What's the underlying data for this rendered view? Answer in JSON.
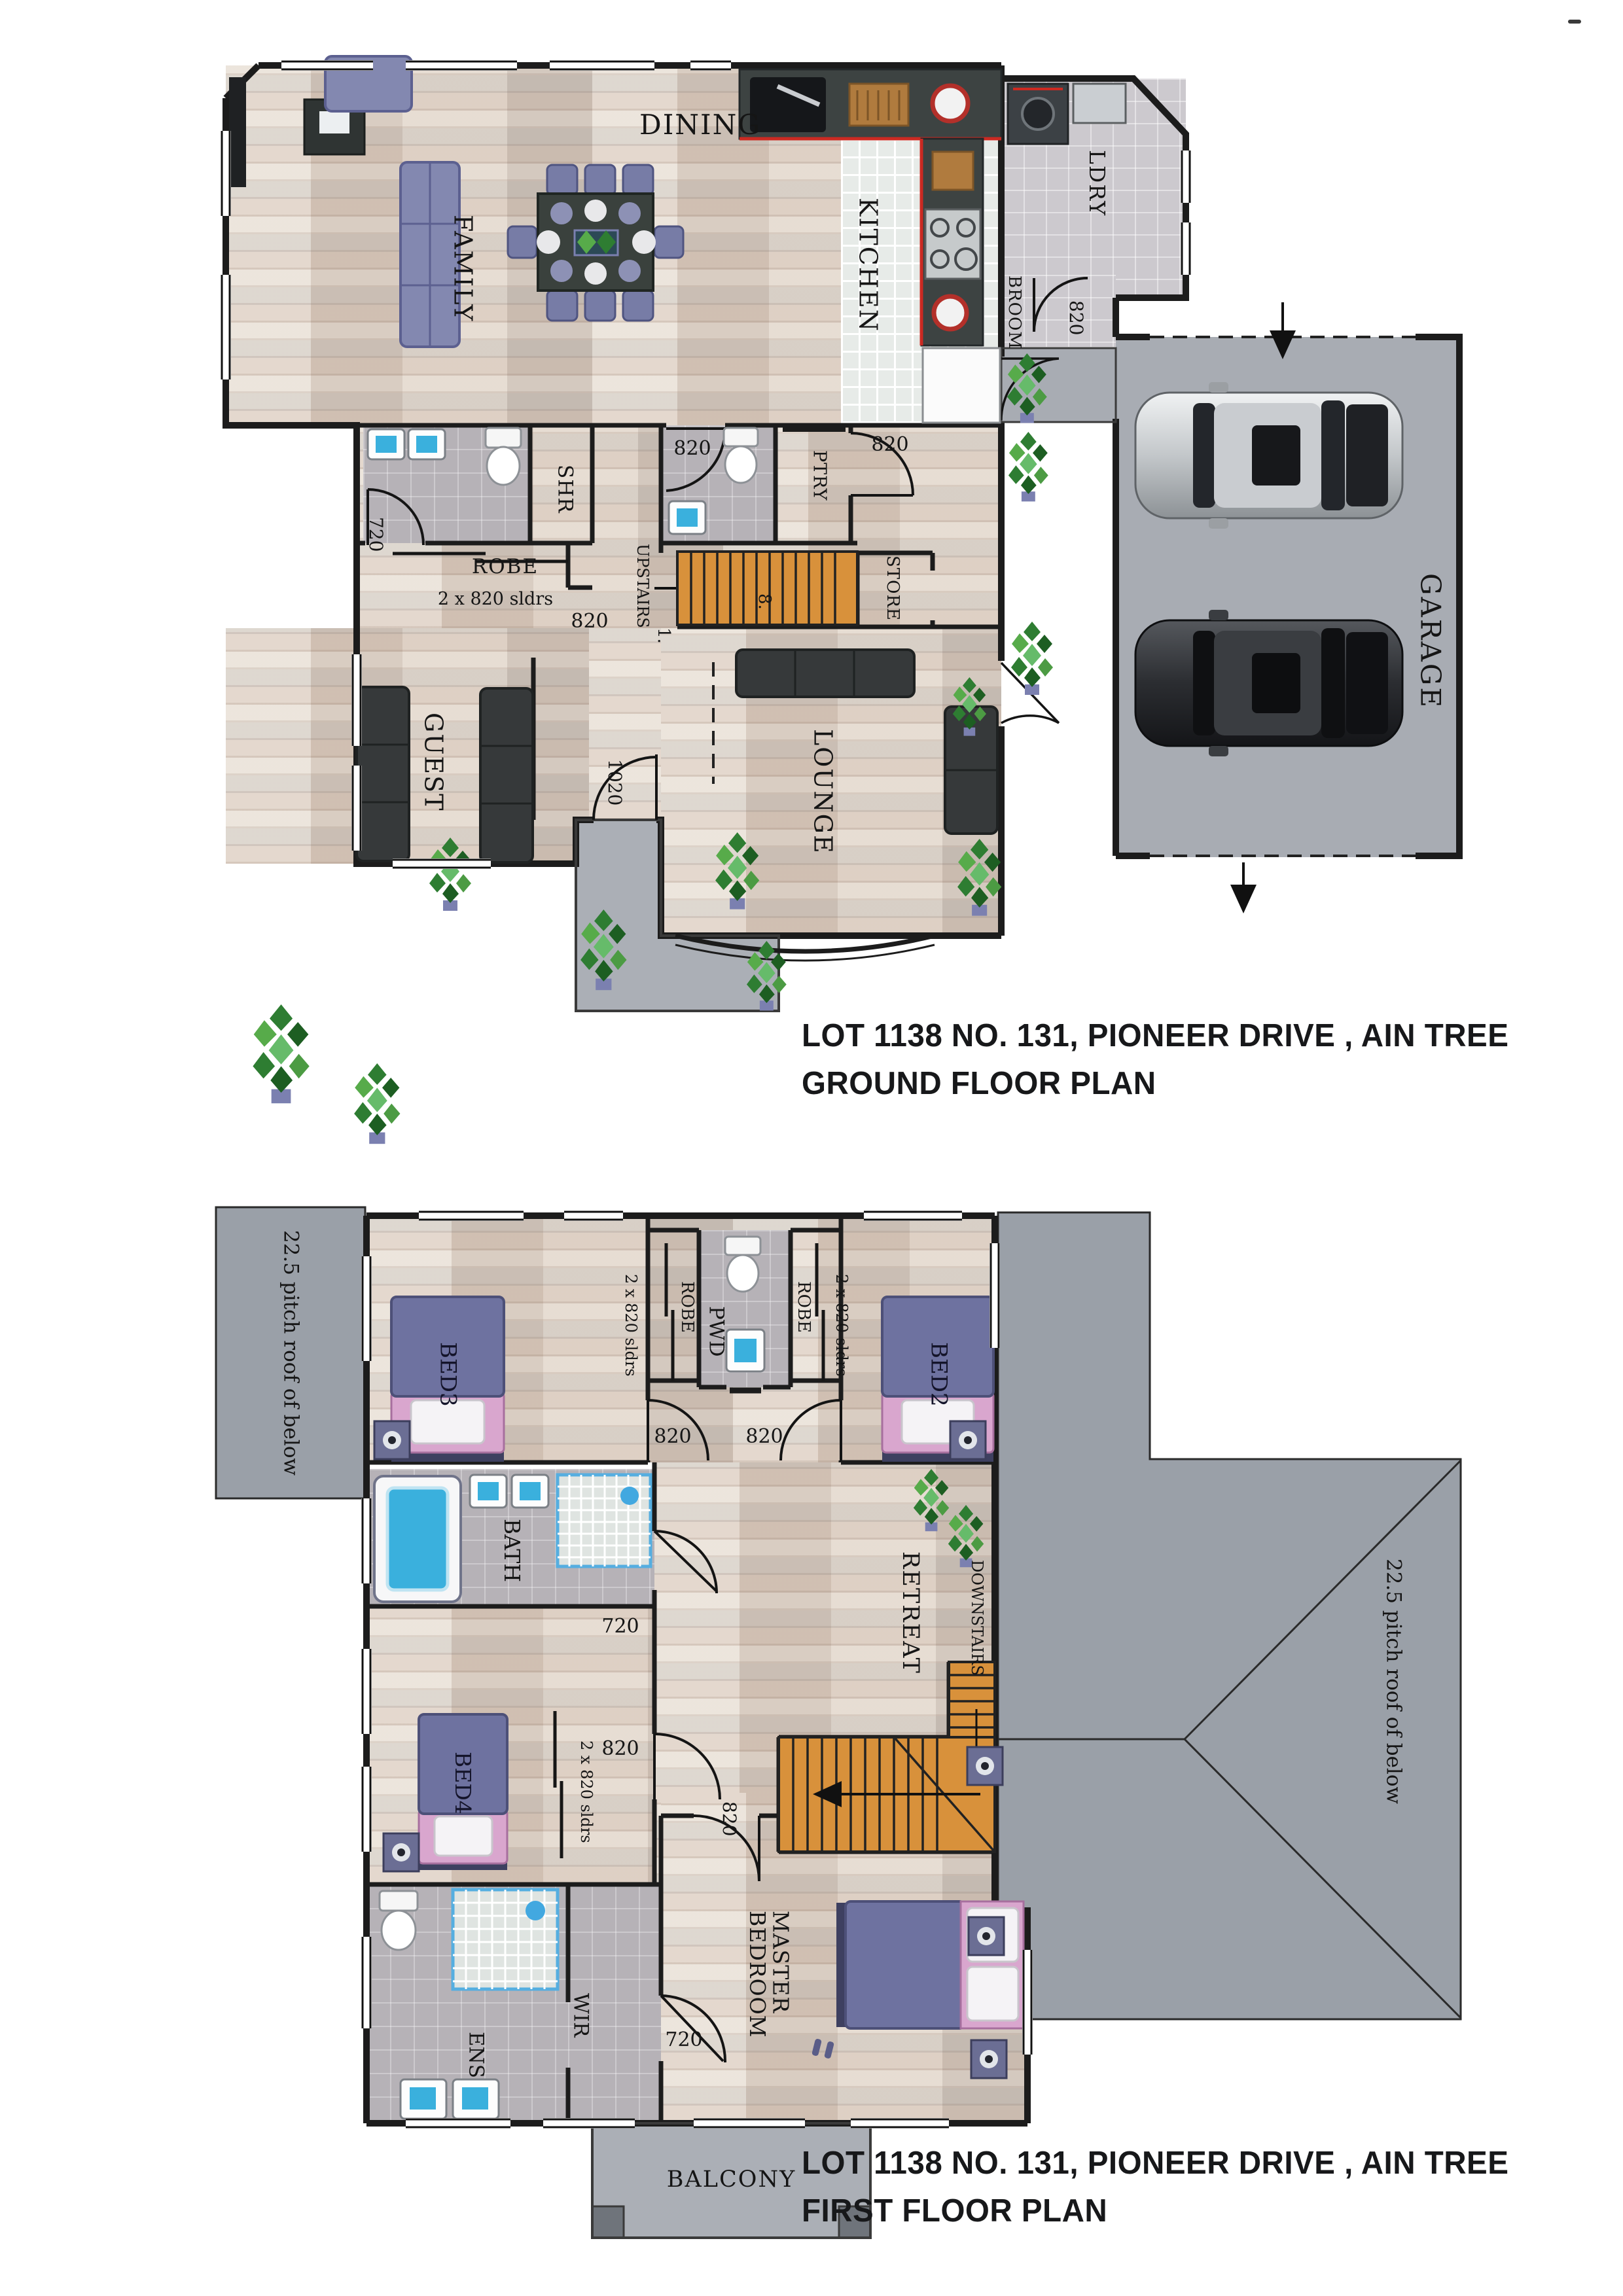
{
  "colors": {
    "wall": "#1c1c1c",
    "stairs": "#d8913b",
    "roof": "#9aa0a8",
    "garage_slab": "#a8acb3",
    "bed_purple": "#6e72a0",
    "bed_pink": "#d9a6ce",
    "sofa_dark": "#36393a",
    "sofa_purple": "#8388b0",
    "accent_red": "#cc2a22",
    "plant_green": "#3f9b3f"
  },
  "ground_floor": {
    "rooms": {
      "dining": "DINING",
      "family": "FAMILY",
      "kitchen": "KITCHEN",
      "ldry": "LDRY",
      "broom": "BROOM",
      "garage": "GARAGE",
      "ptry": "PTRY",
      "store": "STORE",
      "upstairs": "UPSTAIRS",
      "lounge": "LOUNGE",
      "guest": "GUEST",
      "robe": "ROBE",
      "shr": "SHR"
    },
    "dims": {
      "d820": "820",
      "d720": "720",
      "d1020": "1020",
      "sliders": "2 x 820 sldrs",
      "stair_top": "8.",
      "stair_bottom": "1."
    },
    "caption_line1": "LOT 1138 NO. 131, PIONEER DRIVE , AIN TREE",
    "caption_line2": "GROUND FLOOR PLAN"
  },
  "first_floor": {
    "rooms": {
      "bed2": "BED2",
      "bed3": "BED3",
      "bed4": "BED4",
      "master": "MASTER BEDROOM",
      "retreat": "RETREAT",
      "bath": "BATH",
      "ens": "ENS",
      "wir": "WIR",
      "pwd": "PWD",
      "robe": "ROBE",
      "downstairs": "DOWNSTAIRS",
      "balcony": "BALCONY"
    },
    "dims": {
      "d820": "820",
      "d720": "720",
      "sliders": "2 x 820 sldrs"
    },
    "roof_note": "22.5 pitch roof of below",
    "caption_line1": "LOT 1138 NO. 131, PIONEER DRIVE , AIN TREE",
    "caption_line2": "FIRST FLOOR PLAN"
  }
}
